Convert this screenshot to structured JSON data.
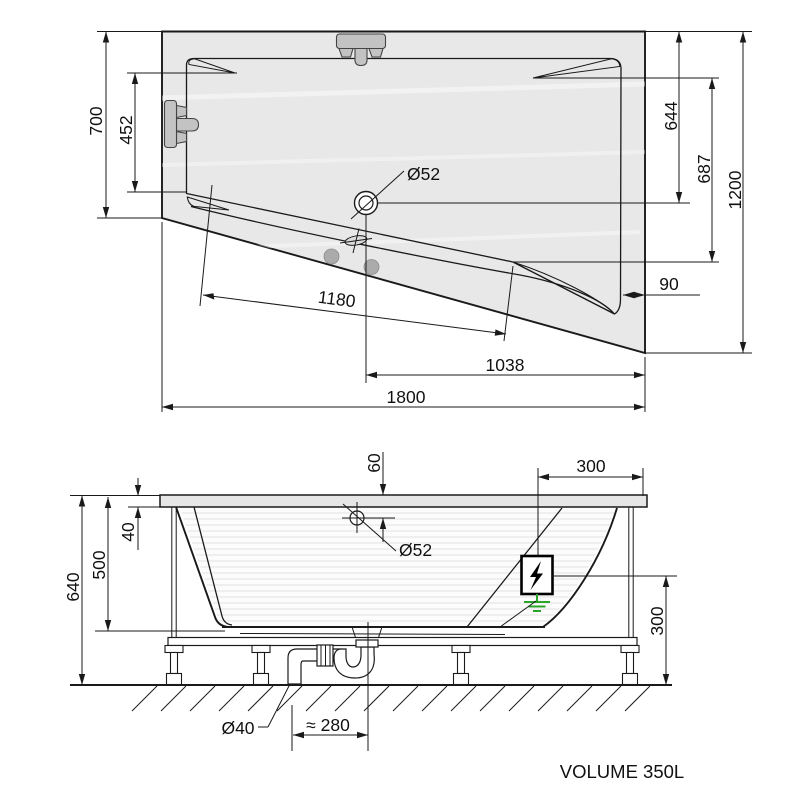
{
  "top_view": {
    "height_left": "700",
    "backrest_width": "452",
    "drain_from_top": "644",
    "inner_height_right": "687",
    "height_right": "1200",
    "rim_right": "90",
    "drain_diameter": "Ø52",
    "inner_diagonal": "1180",
    "drain_from_right": "1038",
    "width": "1800"
  },
  "side_view": {
    "overflow_from_rim": "60",
    "rim_height": "40",
    "depth": "500",
    "total_height": "640",
    "overflow_diameter": "Ø52",
    "electric_from_edge": "300",
    "electric_height": "300",
    "waste_diameter": "Ø40",
    "trap_offset": "≈ 280"
  },
  "footer": {
    "volume": "VOLUME 350L"
  },
  "colors": {
    "line": "#1a1a1a",
    "tub_fill": "#e8e8e8",
    "fixture_fill": "#c3c3c3",
    "ground_green": "#2aa52a"
  }
}
